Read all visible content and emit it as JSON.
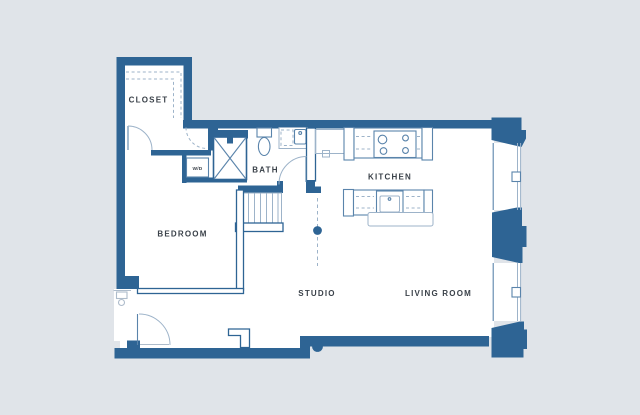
{
  "colors": {
    "background": "#e0e4e9",
    "floor": "#ffffff",
    "wall": "#2e6494",
    "line_medium": "#5a84ab",
    "line_light": "#9db3c9",
    "fixture": "#aebccb",
    "label": "#3a4149"
  },
  "rooms": {
    "closet": {
      "label": "CLOSET"
    },
    "bedroom": {
      "label": "BEDROOM"
    },
    "bath": {
      "label": "BATH"
    },
    "washer_dryer": {
      "label": "W/D"
    },
    "kitchen": {
      "label": "KITCHEN"
    },
    "studio": {
      "label": "STUDIO"
    },
    "living_room": {
      "label": "LIVING ROOM"
    }
  }
}
